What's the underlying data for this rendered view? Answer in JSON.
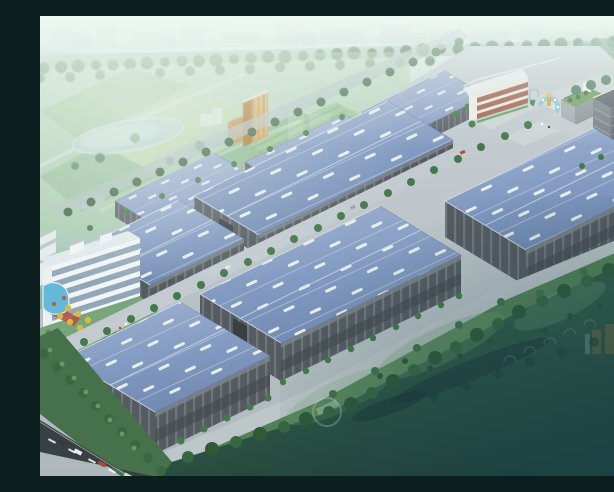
{
  "scene": {
    "subject": "aerial rendering of industrial logistics park",
    "view": "bird's-eye oblique",
    "elements": {
      "warehouses_blue_roof": 9,
      "office_building_glass": "5-story white slab with rooftop penthouses",
      "admin_building": "3-story white building with red window bands",
      "dormitory": "gray mid-rise slab at park entrance",
      "entrance": "circular fountain plaza with gold sculpture",
      "landmark": "orange high-rise tower in background park",
      "surroundings": [
        "hazy city skyline",
        "tree-lined boundary roads",
        "pond and farm fields",
        "dark green field fading to teal fog",
        "highway with cars at lower left",
        "swimming pool and yellow ornamental trees"
      ]
    }
  },
  "palette": {
    "sky_haze": "#d9ece7",
    "skyline_blob": "#b7d4d0",
    "park_green": "#a9cba3",
    "tree_dark": "#33603a",
    "roof_blue_light": "#9fb2d4",
    "roof_blue_dark": "#6d86b2",
    "skylight_white": "#edf4ee",
    "wall_dark": "#4e545b",
    "pilaster": "#6f767e",
    "road_light": "#c2cad0",
    "platform_gray": "#b9c3c7",
    "field_dark": "#1d4038",
    "fog_teal": "#194049",
    "pool_blue": "#5fb7d9",
    "fountain_blue": "#7cc4dd",
    "sculpture_gold": "#d8a43c",
    "tower_orange": "#cf9a4c",
    "autumn_tree": "#d9b63e",
    "highway_dark": "#2f383c"
  }
}
